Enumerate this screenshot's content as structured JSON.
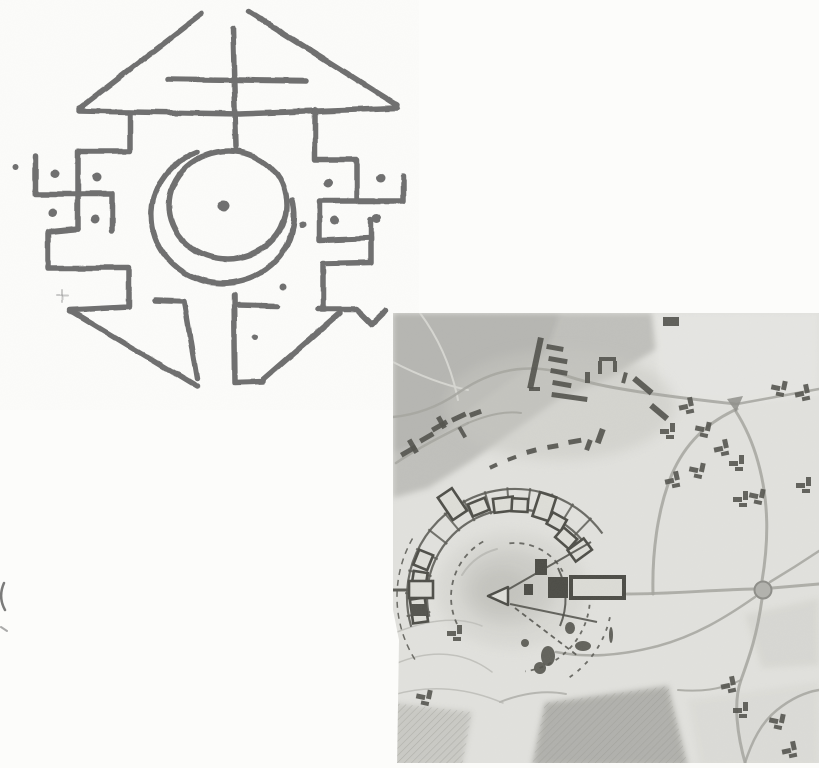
{
  "page": {
    "background": "#fcfcfa",
    "width": 819,
    "height": 768
  },
  "symbol_drawing": {
    "ink": "#6f6f6f",
    "stroke_width": 5.5,
    "strokes": [
      "M202 14 L79 109",
      "M249 12 L397 105",
      "M79 111 L240 114 L397 108",
      "M233 29 L236 147",
      "M168 79 L306 81",
      "M130 113 L130 151 L78 151 L78 229",
      "M35 157 L35 194 L112 194 L112 231",
      "M78 229 L48 232 L48 268 L129 268 L129 307 L70 310 L197 387",
      "M155 300 L184 301 L197 379",
      "M315 110 L315 160 L357 160 L357 201",
      "M403 176 L403 201 L320 201 L320 240 L371 238 L371 263 L323 264 L323 308",
      "M371 219 L371 240",
      "M318 309 L357 309 L372 324 L386 310",
      "M340 313 L263 380",
      "M234 295 L235 383 L263 382",
      "M238 305 L278 306",
      "M197 152 A71 68 0 1 0 292 200"
    ],
    "inner_circle": {
      "cx": 228,
      "cy": 205,
      "rx": 59,
      "ry": 54
    },
    "dots": [
      {
        "x": 15,
        "y": 166,
        "r": 3
      },
      {
        "x": 55,
        "y": 174,
        "r": 4.5
      },
      {
        "x": 97,
        "y": 178,
        "r": 4.5
      },
      {
        "x": 53,
        "y": 213,
        "r": 4.5
      },
      {
        "x": 95,
        "y": 219,
        "r": 4.5
      },
      {
        "x": 328,
        "y": 183,
        "r": 4.5
      },
      {
        "x": 380,
        "y": 178,
        "r": 4.5
      },
      {
        "x": 335,
        "y": 221,
        "r": 4.5
      },
      {
        "x": 377,
        "y": 218,
        "r": 4.5
      },
      {
        "x": 302,
        "y": 224,
        "r": 3.5
      },
      {
        "x": 224,
        "y": 206,
        "r": 5.5
      },
      {
        "x": 283,
        "y": 287,
        "r": 3.5
      },
      {
        "x": 255,
        "y": 337,
        "r": 3
      }
    ],
    "faint_marks": [
      {
        "d": "M56 296 L68 296",
        "w": 2,
        "o": 0.35
      },
      {
        "d": "M62 290 L62 302",
        "w": 2,
        "o": 0.35
      }
    ]
  },
  "edge_artifacts": [
    {
      "d": "M4 583 C0 592 0 601 5 610",
      "w": 2.5,
      "o": 0.8
    },
    {
      "d": "M1 627 L7 631",
      "w": 2,
      "o": 0.5
    }
  ],
  "site_map": {
    "base": "#e2e2de",
    "dark": "#53534d",
    "road_color": "#a4a49f",
    "patches": [
      {
        "pts": "393,313 652,313 658,348 610,378 560,398 515,430 470,462 428,488 393,498",
        "fill": "#bdbdb8",
        "o": 0.9,
        "hatch": false
      },
      {
        "pts": "393,313 560,313 545,355 480,402 432,440 393,452",
        "fill": "#b2b2ad",
        "o": 0.75,
        "hatch": false
      },
      {
        "pts": "652,313 819,313 819,395 737,404 660,398",
        "fill": "#e7e7e3",
        "o": 0.8,
        "hatch": false
      },
      {
        "pts": "745,615 819,598 819,665 762,668",
        "fill": "#d2d2cd",
        "o": 0.6,
        "hatch": false
      },
      {
        "pts": "545,703 668,686 688,766 532,766",
        "fill": "#acaca7",
        "o": 0.9,
        "hatch": true
      },
      {
        "pts": "393,703 472,712 462,766 393,766",
        "fill": "#c6c6c1",
        "o": 0.85,
        "hatch": true
      },
      {
        "pts": "688,700 819,682 819,766 700,766",
        "fill": "#d8d8d3",
        "o": 0.6,
        "hatch": false
      }
    ],
    "soft_ellipses": [
      {
        "cx": 560,
        "cy": 405,
        "rx": 115,
        "ry": 55,
        "fill": "#c7c7c2",
        "o": 0.5
      },
      {
        "cx": 512,
        "cy": 590,
        "rx": 75,
        "ry": 58,
        "fill": "#cfcfca",
        "o": 0.5
      },
      {
        "cx": 508,
        "cy": 588,
        "rx": 48,
        "ry": 38,
        "fill": "#c2c2bd",
        "o": 0.5
      },
      {
        "cx": 502,
        "cy": 590,
        "rx": 28,
        "ry": 22,
        "fill": "#b8b8b3",
        "o": 0.45
      }
    ],
    "faint_paths": [
      {
        "d": "M397 632 C428 620 458 616 482 626",
        "w": 1.5,
        "c": "#c2c2bd"
      },
      {
        "d": "M395 664 C432 648 466 652 492 672",
        "w": 1.5,
        "c": "#c2c2bd"
      },
      {
        "d": "M393 695 C430 684 468 688 503 703",
        "w": 1.5,
        "c": "#c2c2bd"
      },
      {
        "d": "M420 313 C440 340 452 370 458 400",
        "w": 2,
        "c": "#d6d6d1"
      },
      {
        "d": "M393 362 C420 376 444 385 468 390",
        "w": 2,
        "c": "#d6d6d1"
      },
      {
        "d": "M500 702 C523 693 545 690 566 694",
        "w": 2,
        "c": "#b6b6b1"
      },
      {
        "d": "M462 575 C470 562 482 553 497 549",
        "w": 2,
        "c": "#bcbcb7"
      }
    ],
    "roads": [
      {
        "d": "M627 594 C670 594 710 590 754 589",
        "w": 3
      },
      {
        "d": "M762 581 C768 545 770 505 758 462 C752 440 744 424 735 410",
        "w": 3
      },
      {
        "d": "M762 599 C757 635 750 655 741 680 C733 702 737 735 746 766",
        "w": 3
      },
      {
        "d": "M772 588 L819 584",
        "w": 3
      },
      {
        "d": "M770 582 C790 570 804 561 819 551",
        "w": 2.5
      },
      {
        "d": "M755 597 C725 618 695 636 658 646 C620 656 586 658 556 652",
        "w": 2.5
      },
      {
        "d": "M737 409 C706 423 685 444 672 474 C657 510 652 555 653 594",
        "w": 3
      },
      {
        "d": "M737 404 L819 389",
        "w": 2.5
      },
      {
        "d": "M735 404 C700 400 662 396 622 389 C592 384 570 378 554 371",
        "w": 3
      },
      {
        "d": "M554 371 C520 364 488 372 458 393 C438 407 415 415 393 417",
        "w": 2.5
      },
      {
        "d": "M396 463 C418 448 442 436 468 423",
        "w": 2.5
      },
      {
        "d": "M468 423 C490 414 506 411 521 413",
        "w": 2
      },
      {
        "d": "M744 766 C752 740 762 722 777 710 C792 698 806 692 819 690",
        "w": 2.5
      },
      {
        "d": "M741 680 C720 690 700 692 678 690",
        "w": 2
      }
    ],
    "junction": {
      "cx": 763,
      "cy": 590,
      "r": 8.5,
      "fill": "#b2b2ad",
      "stroke": "#8d8d88"
    },
    "road_triangle": {
      "pts": "727,399 743,396 736,412",
      "fill": "#8e8e89"
    },
    "ring": {
      "cx": 515,
      "cy": 597,
      "wall_color": "#5c5c56",
      "building_stroke": "#4e4e48",
      "building_fill": "#deded8",
      "walls": [
        {
          "r": 88,
          "a1": 193,
          "a2": 40,
          "w": 2.2,
          "dash": ""
        },
        {
          "r": 108,
          "a1": 196,
          "a2": 36,
          "w": 2.2,
          "dash": ""
        },
        {
          "r": 118,
          "a1": 212,
          "a2": 150,
          "w": 1.5,
          "dash": "6 5"
        },
        {
          "r": 64,
          "a1": 205,
          "a2": 118,
          "w": 1.8,
          "dash": "5 5"
        },
        {
          "r": 54,
          "a1": 96,
          "a2": 28,
          "w": 1.8,
          "dash": "5 5"
        },
        {
          "r": 75,
          "a1": -6,
          "a2": -82,
          "w": 1.8,
          "dash": "4 5"
        },
        {
          "r": 97,
          "a1": -12,
          "a2": -58,
          "w": 1.8,
          "dash": "4 6"
        }
      ],
      "divider_angles": [
        190,
        178,
        166,
        154,
        142,
        130,
        118,
        106,
        94,
        82,
        70,
        58,
        46
      ],
      "divider_r": [
        86,
        110
      ],
      "buildings": [
        {
          "a": 188,
          "r": 97,
          "len": 24,
          "dep": 15
        },
        {
          "a": 171,
          "r": 97,
          "len": 20,
          "dep": 14
        },
        {
          "a": 158,
          "r": 99,
          "len": 16,
          "dep": 15
        },
        {
          "a": 124,
          "r": 112,
          "len": 17,
          "dep": 27
        },
        {
          "a": 112,
          "r": 97,
          "len": 18,
          "dep": 13
        },
        {
          "a": 97,
          "r": 93,
          "len": 20,
          "dep": 14
        },
        {
          "a": 87,
          "r": 92,
          "len": 16,
          "dep": 13
        },
        {
          "a": 72,
          "r": 95,
          "len": 17,
          "dep": 25
        },
        {
          "a": 61,
          "r": 86,
          "len": 16,
          "dep": 13
        },
        {
          "a": 49,
          "r": 78,
          "len": 18,
          "dep": 13
        },
        {
          "a": 36,
          "r": 80,
          "len": 14,
          "dep": 20
        }
      ]
    },
    "bastion": {
      "outline_rect": {
        "x": 409,
        "y": 581,
        "w": 24,
        "h": 17
      },
      "dark_rect": {
        "x": 411,
        "y": 604,
        "w": 16,
        "h": 12
      },
      "stub": "M393 590 L409 590"
    },
    "center_complex": {
      "color": "#4c4c46",
      "triangle": "M488 596 L508 587 L508 605 Z",
      "lines": [
        {
          "d": "M509 589 L591 542",
          "w": 2,
          "dash": ""
        },
        {
          "d": "M510 604 L597 622",
          "w": 2,
          "dash": ""
        },
        {
          "d": "M558 568 Q572 597 560 626",
          "w": 2,
          "dash": ""
        },
        {
          "d": "M515 608 L578 656",
          "w": 1.8,
          "dash": "5 4"
        }
      ],
      "church_outline": {
        "x": 571,
        "y": 577,
        "w": 53,
        "h": 21
      },
      "dark_rects": [
        {
          "x": 548,
          "y": 577,
          "w": 20,
          "h": 21
        },
        {
          "x": 535,
          "y": 559,
          "w": 12,
          "h": 16
        },
        {
          "x": 524,
          "y": 584,
          "w": 9,
          "h": 11
        }
      ]
    },
    "bars": [
      {
        "x": 538,
        "y": 337,
        "w": 6,
        "h": 52,
        "rot": 12
      },
      {
        "x": 547,
        "y": 344,
        "w": 17,
        "h": 5,
        "rot": 10
      },
      {
        "x": 549,
        "y": 356,
        "w": 19,
        "h": 5,
        "rot": 10
      },
      {
        "x": 551,
        "y": 368,
        "w": 17,
        "h": 5,
        "rot": 10
      },
      {
        "x": 553,
        "y": 380,
        "w": 19,
        "h": 5,
        "rot": 10
      },
      {
        "x": 529,
        "y": 387,
        "w": 11,
        "h": 4,
        "rot": 0
      },
      {
        "x": 552,
        "y": 392,
        "w": 36,
        "h": 5,
        "rot": 8
      },
      {
        "x": 585,
        "y": 372,
        "w": 5,
        "h": 11,
        "rot": 0
      },
      {
        "x": 599,
        "y": 357,
        "w": 17,
        "h": 4,
        "rot": 0
      },
      {
        "x": 598,
        "y": 361,
        "w": 4,
        "h": 13,
        "rot": 0
      },
      {
        "x": 613,
        "y": 361,
        "w": 4,
        "h": 11,
        "rot": 0
      },
      {
        "x": 636,
        "y": 376,
        "w": 23,
        "h": 6,
        "rot": 40
      },
      {
        "x": 653,
        "y": 403,
        "w": 21,
        "h": 6,
        "rot": 40
      },
      {
        "x": 624,
        "y": 372,
        "w": 4,
        "h": 11,
        "rot": 15
      },
      {
        "x": 663,
        "y": 317,
        "w": 16,
        "h": 9,
        "rot": 0
      },
      {
        "x": 600,
        "y": 428,
        "w": 6,
        "h": 15,
        "rot": 20
      },
      {
        "x": 588,
        "y": 439,
        "w": 5,
        "h": 11,
        "rot": 20
      },
      {
        "x": 568,
        "y": 440,
        "w": 13,
        "h": 5,
        "rot": -10
      },
      {
        "x": 547,
        "y": 445,
        "w": 11,
        "h": 5,
        "rot": -10
      },
      {
        "x": 526,
        "y": 450,
        "w": 10,
        "h": 5,
        "rot": -15
      },
      {
        "x": 507,
        "y": 458,
        "w": 9,
        "h": 4,
        "rot": -20
      },
      {
        "x": 489,
        "y": 466,
        "w": 8,
        "h": 4,
        "rot": -25
      },
      {
        "x": 400,
        "y": 453,
        "w": 17,
        "h": 5,
        "rot": -30
      },
      {
        "x": 407,
        "y": 441,
        "w": 5,
        "h": 15,
        "rot": -30
      },
      {
        "x": 419,
        "y": 439,
        "w": 15,
        "h": 5,
        "rot": -30
      },
      {
        "x": 431,
        "y": 428,
        "w": 17,
        "h": 5,
        "rot": -30
      },
      {
        "x": 436,
        "y": 418,
        "w": 5,
        "h": 13,
        "rot": -30
      },
      {
        "x": 451,
        "y": 418,
        "w": 15,
        "h": 5,
        "rot": -25
      },
      {
        "x": 461,
        "y": 426,
        "w": 12,
        "h": 4,
        "rot": 60
      },
      {
        "x": 469,
        "y": 413,
        "w": 12,
        "h": 5,
        "rot": -20
      }
    ],
    "clusters": [
      [
        687,
        407
      ],
      [
        668,
        432
      ],
      [
        703,
        430
      ],
      [
        722,
        449
      ],
      [
        737,
        464
      ],
      [
        697,
        471
      ],
      [
        673,
        481
      ],
      [
        741,
        500
      ],
      [
        757,
        497
      ],
      [
        803,
        394
      ],
      [
        804,
        486
      ],
      [
        779,
        389
      ],
      [
        729,
        686
      ],
      [
        741,
        711
      ],
      [
        777,
        722
      ],
      [
        790,
        751
      ],
      [
        455,
        634
      ],
      [
        424,
        698
      ]
    ],
    "blobs": [
      [
        548,
        656,
        7,
        10
      ],
      [
        583,
        646,
        8,
        5
      ],
      [
        570,
        628,
        5,
        6
      ],
      [
        540,
        668,
        6,
        6
      ],
      [
        611,
        635,
        2,
        8
      ],
      [
        525,
        643,
        4,
        4
      ]
    ],
    "white_edges": [
      {
        "pts": "393,610 399,640 397,768 393,768"
      },
      {
        "pts": "393,763 819,763 819,768 393,768"
      }
    ]
  }
}
